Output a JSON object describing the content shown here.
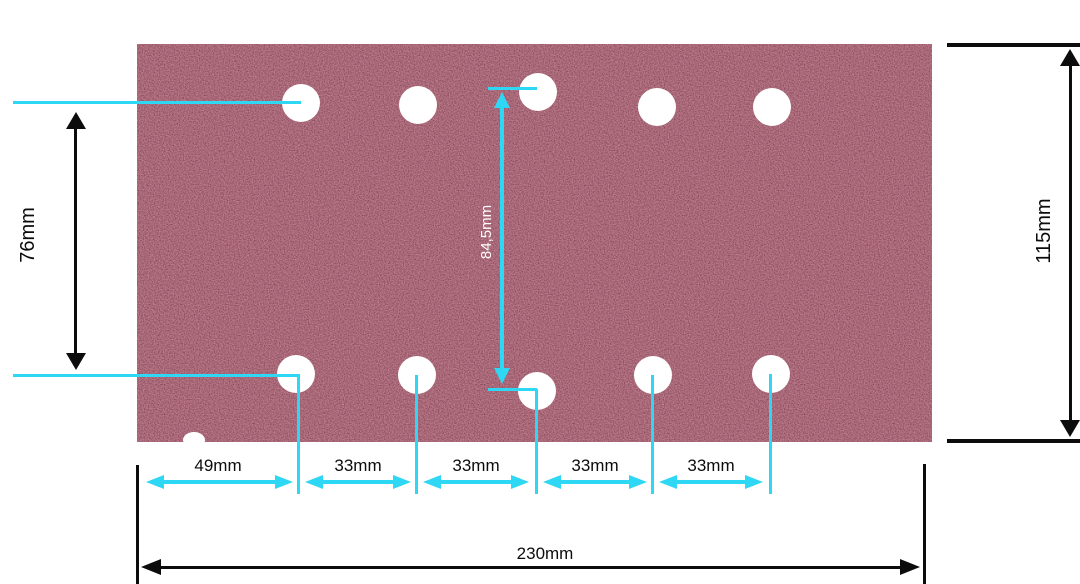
{
  "diagram": {
    "type": "sanding-sheet-dimension-diagram",
    "sheet": {
      "hole_count_top": 5,
      "hole_count_bottom": 5,
      "description_color": "dark red abrasive grit"
    },
    "labels": {
      "left_height": "76mm",
      "center_height": "84,5mm",
      "right_height": "115mm",
      "total_width": "230mm",
      "segment_1": "49mm",
      "segment_2": "33mm",
      "segment_3": "33mm",
      "segment_4": "33mm",
      "segment_5": "33mm"
    },
    "colors": {
      "dimension_accent": "#2ed7f3",
      "dimension_black": "#0c0c0c",
      "sheet_base": "#5c1a26",
      "hole": "#ffffff",
      "background": "#ffffff"
    }
  }
}
